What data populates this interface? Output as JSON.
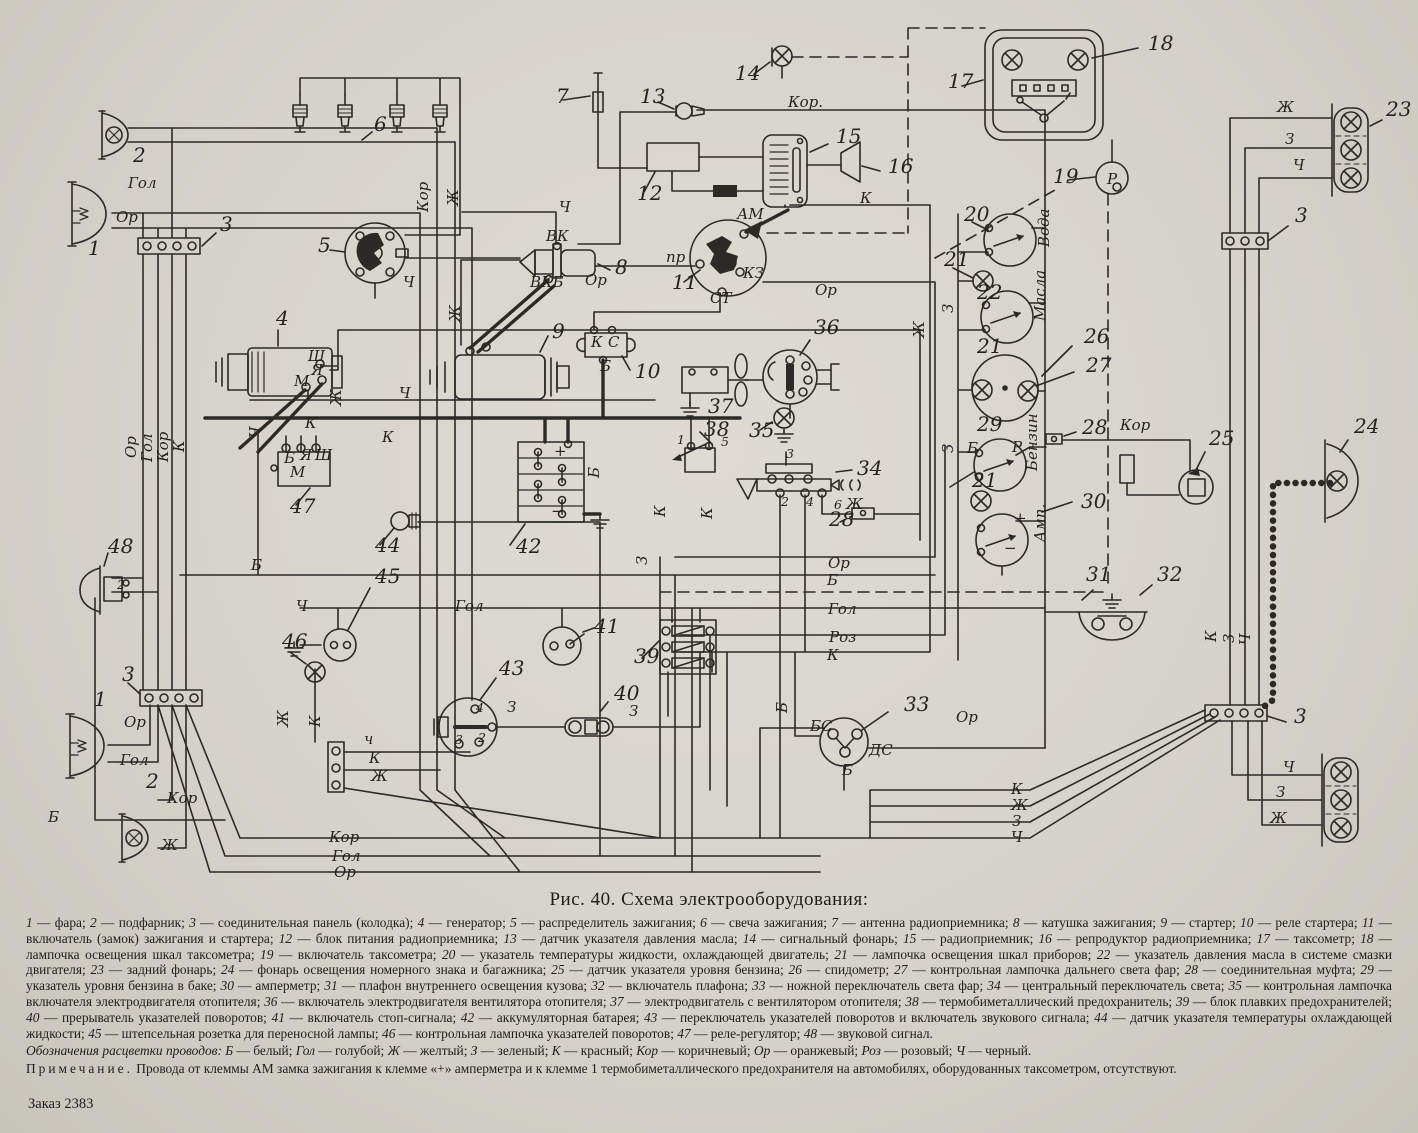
{
  "page": {
    "caption": "Рис. 40. Схема электрооборудования:",
    "order": "Заказ 2383"
  },
  "legend": {
    "items": [
      {
        "n": "1",
        "t": "фара"
      },
      {
        "n": "2",
        "t": "подфарник"
      },
      {
        "n": "3",
        "t": "соединительная панель (колодка)"
      },
      {
        "n": "4",
        "t": "генератор"
      },
      {
        "n": "5",
        "t": "распределитель зажигания"
      },
      {
        "n": "6",
        "t": "свеча зажигания"
      },
      {
        "n": "7",
        "t": "антенна радиоприемника"
      },
      {
        "n": "8",
        "t": "катушка зажигания"
      },
      {
        "n": "9",
        "t": "стартер"
      },
      {
        "n": "10",
        "t": "реле стартера"
      },
      {
        "n": "11",
        "t": "включатель (замок) зажигания и стартера"
      },
      {
        "n": "12",
        "t": "блок питания радиоприемника"
      },
      {
        "n": "13",
        "t": "датчик указателя давления масла"
      },
      {
        "n": "14",
        "t": "сигнальный фонарь"
      },
      {
        "n": "15",
        "t": "радиоприемник"
      },
      {
        "n": "16",
        "t": "репродуктор радиоприемника"
      },
      {
        "n": "17",
        "t": "таксометр"
      },
      {
        "n": "18",
        "t": "лампочка освещения шкал таксометра"
      },
      {
        "n": "19",
        "t": "включатель таксометра"
      },
      {
        "n": "20",
        "t": "указатель температуры жидкости, охлаждающей двигатель"
      },
      {
        "n": "21",
        "t": "лампочка освещения шкал приборов"
      },
      {
        "n": "22",
        "t": "указатель давления масла в системе смазки двигателя"
      },
      {
        "n": "23",
        "t": "задний фонарь"
      },
      {
        "n": "24",
        "t": "фонарь освещения номерного знака и багажника"
      },
      {
        "n": "25",
        "t": "датчик указателя уровня бензина"
      },
      {
        "n": "26",
        "t": "спидометр"
      },
      {
        "n": "27",
        "t": "контрольная лампочка дальнего света фар"
      },
      {
        "n": "28",
        "t": "соединительная муфта"
      },
      {
        "n": "29",
        "t": "указатель уровня бензина в баке"
      },
      {
        "n": "30",
        "t": "амперметр"
      },
      {
        "n": "31",
        "t": "плафон внутреннего освещения кузова"
      },
      {
        "n": "32",
        "t": "включатель плафона"
      },
      {
        "n": "33",
        "t": "ножной переключатель света фар"
      },
      {
        "n": "34",
        "t": "центральный переключатель света"
      },
      {
        "n": "35",
        "t": "контрольная лампочка включателя электродвигателя отопителя"
      },
      {
        "n": "36",
        "t": "включатель электродвигателя вентилятора отопителя"
      },
      {
        "n": "37",
        "t": "электродвигатель с вентилятором отопителя"
      },
      {
        "n": "38",
        "t": "термобиметаллический предохранитель"
      },
      {
        "n": "39",
        "t": "блок плавких предохранителей"
      },
      {
        "n": "40",
        "t": "прерыватель указателей поворотов"
      },
      {
        "n": "41",
        "t": "включатель стоп-сигнала"
      },
      {
        "n": "42",
        "t": "аккумуляторная батарея"
      },
      {
        "n": "43",
        "t": "переключатель указателей поворотов и включатель звукового сигнала"
      },
      {
        "n": "44",
        "t": "датчик указателя температуры охлаждающей жидкости"
      },
      {
        "n": "45",
        "t": "штепсельная розетка для переносной лампы"
      },
      {
        "n": "46",
        "t": "контрольная лампочка указателей поворотов"
      },
      {
        "n": "47",
        "t": "реле-регулятор"
      },
      {
        "n": "48",
        "t": "звуковой сигнал"
      }
    ]
  },
  "wire_colors": {
    "lead": "Обозначения расцветки проводов:",
    "items": [
      {
        "a": "Б",
        "t": "белый"
      },
      {
        "a": "Гол",
        "t": "голубой"
      },
      {
        "a": "Ж",
        "t": "желтый"
      },
      {
        "a": "З",
        "t": "зеленый"
      },
      {
        "a": "К",
        "t": "красный"
      },
      {
        "a": "Кор",
        "t": "коричневый"
      },
      {
        "a": "Ор",
        "t": "оранжевый"
      },
      {
        "a": "Роз",
        "t": "розовый"
      },
      {
        "a": "Ч",
        "t": "черный"
      }
    ]
  },
  "note": {
    "lead": "Примечание.",
    "text": "Провода от клеммы АМ замка зажигания к клемме «+» амперметра и к клемме 1 термобиметаллического предохранителя на автомобилях, оборудованных таксометром, отсутствуют."
  },
  "diagram": {
    "ink": "#2b2a26",
    "callouts": [
      {
        "t": "1",
        "x": 88,
        "y": 255
      },
      {
        "t": "2",
        "x": 133,
        "y": 162
      },
      {
        "t": "3",
        "x": 220,
        "y": 231
      },
      {
        "t": "4",
        "x": 276,
        "y": 325
      },
      {
        "t": "5",
        "x": 318,
        "y": 252
      },
      {
        "t": "6",
        "x": 374,
        "y": 131
      },
      {
        "t": "7",
        "x": 556,
        "y": 103
      },
      {
        "t": "8",
        "x": 615,
        "y": 274
      },
      {
        "t": "9",
        "x": 552,
        "y": 338
      },
      {
        "t": "10",
        "x": 635,
        "y": 378
      },
      {
        "t": "11",
        "x": 672,
        "y": 289
      },
      {
        "t": "12",
        "x": 637,
        "y": 200
      },
      {
        "t": "13",
        "x": 640,
        "y": 103
      },
      {
        "t": "14",
        "x": 735,
        "y": 80
      },
      {
        "t": "15",
        "x": 836,
        "y": 143
      },
      {
        "t": "16",
        "x": 888,
        "y": 173
      },
      {
        "t": "17",
        "x": 948,
        "y": 88
      },
      {
        "t": "18",
        "x": 1148,
        "y": 50
      },
      {
        "t": "19",
        "x": 1053,
        "y": 183
      },
      {
        "t": "20",
        "x": 964,
        "y": 221
      },
      {
        "t": "21",
        "x": 944,
        "y": 266
      },
      {
        "t": "22",
        "x": 977,
        "y": 299
      },
      {
        "t": "21",
        "x": 977,
        "y": 353
      },
      {
        "t": "26",
        "x": 1084,
        "y": 343
      },
      {
        "t": "27",
        "x": 1086,
        "y": 372
      },
      {
        "t": "28",
        "x": 1082,
        "y": 434
      },
      {
        "t": "29",
        "x": 977,
        "y": 431
      },
      {
        "t": "21",
        "x": 972,
        "y": 487
      },
      {
        "t": "30",
        "x": 1081,
        "y": 508
      },
      {
        "t": "25",
        "x": 1209,
        "y": 445
      },
      {
        "t": "24",
        "x": 1354,
        "y": 433
      },
      {
        "t": "31",
        "x": 1086,
        "y": 581
      },
      {
        "t": "32",
        "x": 1157,
        "y": 581
      },
      {
        "t": "33",
        "x": 904,
        "y": 711
      },
      {
        "t": "34",
        "x": 857,
        "y": 475
      },
      {
        "t": "35",
        "x": 749,
        "y": 437
      },
      {
        "t": "36",
        "x": 814,
        "y": 334
      },
      {
        "t": "37",
        "x": 708,
        "y": 413
      },
      {
        "t": "38",
        "x": 704,
        "y": 436
      },
      {
        "t": "39",
        "x": 634,
        "y": 663
      },
      {
        "t": "40",
        "x": 614,
        "y": 700
      },
      {
        "t": "41",
        "x": 594,
        "y": 633
      },
      {
        "t": "42",
        "x": 516,
        "y": 553
      },
      {
        "t": "43",
        "x": 499,
        "y": 675
      },
      {
        "t": "44",
        "x": 375,
        "y": 552
      },
      {
        "t": "45",
        "x": 375,
        "y": 583
      },
      {
        "t": "46",
        "x": 282,
        "y": 648
      },
      {
        "t": "47",
        "x": 290,
        "y": 513
      },
      {
        "t": "48",
        "x": 108,
        "y": 553
      },
      {
        "t": "23",
        "x": 1386,
        "y": 116
      },
      {
        "t": "3",
        "x": 1295,
        "y": 222
      },
      {
        "t": "3",
        "x": 1294,
        "y": 723
      },
      {
        "t": "1",
        "x": 94,
        "y": 706
      },
      {
        "t": "2",
        "x": 146,
        "y": 788
      },
      {
        "t": "3",
        "x": 122,
        "y": 681
      },
      {
        "t": "28",
        "x": 829,
        "y": 526
      }
    ],
    "labels": [
      {
        "t": "Гол",
        "x": 128,
        "y": 188
      },
      {
        "t": "Ор",
        "x": 116,
        "y": 222
      },
      {
        "t": "Кор",
        "x": 428,
        "y": 212,
        "v": 1
      },
      {
        "t": "Ж",
        "x": 458,
        "y": 206,
        "v": 1
      },
      {
        "t": "Ор",
        "x": 136,
        "y": 458,
        "v": 1
      },
      {
        "t": "Гол",
        "x": 152,
        "y": 462,
        "v": 1
      },
      {
        "t": "Кор",
        "x": 168,
        "y": 462,
        "v": 1
      },
      {
        "t": "К",
        "x": 184,
        "y": 452,
        "v": 1
      },
      {
        "t": "Ч",
        "x": 559,
        "y": 212
      },
      {
        "t": "ВК",
        "x": 546,
        "y": 241
      },
      {
        "t": "ВКБ",
        "x": 530,
        "y": 287
      },
      {
        "t": "Ор",
        "x": 585,
        "y": 285
      },
      {
        "t": "Ч",
        "x": 403,
        "y": 287
      },
      {
        "t": "Ж",
        "x": 460,
        "y": 322,
        "v": 1
      },
      {
        "t": "Кор.",
        "x": 788,
        "y": 107
      },
      {
        "t": "К",
        "x": 860,
        "y": 203
      },
      {
        "t": "АМ",
        "x": 737,
        "y": 219
      },
      {
        "t": "пр",
        "x": 666,
        "y": 262
      },
      {
        "t": "КЗ",
        "x": 743,
        "y": 278
      },
      {
        "t": "СТ",
        "x": 710,
        "y": 303
      },
      {
        "t": "Ор",
        "x": 815,
        "y": 295
      },
      {
        "t": "Ж",
        "x": 1277,
        "y": 112
      },
      {
        "t": "З",
        "x": 1285,
        "y": 144
      },
      {
        "t": "Ч",
        "x": 1293,
        "y": 170
      },
      {
        "t": "Вода",
        "x": 1049,
        "y": 247,
        "v": 1
      },
      {
        "t": "Масла",
        "x": 1045,
        "y": 321,
        "v": 1
      },
      {
        "t": "Бензин",
        "x": 1037,
        "y": 471,
        "v": 1
      },
      {
        "t": "Амп.",
        "x": 1045,
        "y": 542,
        "v": 1
      },
      {
        "t": "З",
        "x": 953,
        "y": 313,
        "v": 1
      },
      {
        "t": "З",
        "x": 953,
        "y": 453,
        "v": 1
      },
      {
        "t": "Б",
        "x": 967,
        "y": 453
      },
      {
        "t": "Р",
        "x": 1012,
        "y": 452
      },
      {
        "t": "+",
        "x": 1014,
        "y": 523
      },
      {
        "t": "−",
        "x": 1004,
        "y": 553
      },
      {
        "t": "Кор",
        "x": 1120,
        "y": 430
      },
      {
        "t": "Ш",
        "x": 308,
        "y": 361
      },
      {
        "t": "Я",
        "x": 311,
        "y": 375
      },
      {
        "t": "М",
        "x": 294,
        "y": 386
      },
      {
        "t": "Ж",
        "x": 341,
        "y": 406,
        "v": 1
      },
      {
        "t": "К",
        "x": 305,
        "y": 428
      },
      {
        "t": "Ч",
        "x": 260,
        "y": 438,
        "v": 1
      },
      {
        "t": "К",
        "x": 382,
        "y": 442
      },
      {
        "t": "Ч",
        "x": 399,
        "y": 398
      },
      {
        "t": "Б",
        "x": 284,
        "y": 463
      },
      {
        "t": "Я",
        "x": 300,
        "y": 460
      },
      {
        "t": "Ш",
        "x": 315,
        "y": 460
      },
      {
        "t": "М",
        "x": 290,
        "y": 477
      },
      {
        "t": "К",
        "x": 591,
        "y": 347
      },
      {
        "t": "С",
        "x": 608,
        "y": 347
      },
      {
        "t": "Б",
        "x": 600,
        "y": 371
      },
      {
        "t": "+",
        "x": 554,
        "y": 456
      },
      {
        "t": "−",
        "x": 551,
        "y": 516
      },
      {
        "t": "Б",
        "x": 599,
        "y": 478,
        "v": 1
      },
      {
        "t": "Б",
        "x": 251,
        "y": 570
      },
      {
        "t": "Б",
        "x": 48,
        "y": 822
      },
      {
        "t": "К",
        "x": 665,
        "y": 517,
        "v": 1
      },
      {
        "t": "К",
        "x": 712,
        "y": 519,
        "v": 1
      },
      {
        "t": "З",
        "x": 647,
        "y": 565,
        "v": 1
      },
      {
        "t": "1",
        "x": 677,
        "y": 444
      },
      {
        "t": "5",
        "x": 721,
        "y": 446
      },
      {
        "t": "3",
        "x": 786,
        "y": 458
      },
      {
        "t": "2",
        "x": 781,
        "y": 506
      },
      {
        "t": "4",
        "x": 806,
        "y": 506
      },
      {
        "t": "6",
        "x": 834,
        "y": 509
      },
      {
        "t": "Ж",
        "x": 846,
        "y": 509
      },
      {
        "t": "Ор",
        "x": 828,
        "y": 568
      },
      {
        "t": "Б",
        "x": 827,
        "y": 585
      },
      {
        "t": "Гол",
        "x": 828,
        "y": 614
      },
      {
        "t": "Роз",
        "x": 829,
        "y": 642
      },
      {
        "t": "К",
        "x": 827,
        "y": 660
      },
      {
        "t": "Гол",
        "x": 455,
        "y": 611
      },
      {
        "t": "З",
        "x": 507,
        "y": 712
      },
      {
        "t": "З",
        "x": 629,
        "y": 716
      },
      {
        "t": "4",
        "x": 476,
        "y": 712
      },
      {
        "t": "2",
        "x": 478,
        "y": 742
      },
      {
        "t": "3",
        "x": 455,
        "y": 744
      },
      {
        "t": "БС",
        "x": 810,
        "y": 731
      },
      {
        "t": "ДС",
        "x": 869,
        "y": 755
      },
      {
        "t": "Б",
        "x": 842,
        "y": 775
      },
      {
        "t": "Б",
        "x": 787,
        "y": 713,
        "v": 1
      },
      {
        "t": "Ор",
        "x": 956,
        "y": 722
      },
      {
        "t": "Ор",
        "x": 124,
        "y": 727
      },
      {
        "t": "Гол",
        "x": 120,
        "y": 765
      },
      {
        "t": "Кор",
        "x": 167,
        "y": 803
      },
      {
        "t": "Ж",
        "x": 161,
        "y": 850
      },
      {
        "t": "Ч",
        "x": 296,
        "y": 611
      },
      {
        "t": "Ж",
        "x": 288,
        "y": 727,
        "v": 1
      },
      {
        "t": "К",
        "x": 320,
        "y": 727,
        "v": 1
      },
      {
        "t": "ч",
        "x": 364,
        "y": 744
      },
      {
        "t": "К",
        "x": 369,
        "y": 763
      },
      {
        "t": "Ж",
        "x": 371,
        "y": 781
      },
      {
        "t": "Кор",
        "x": 329,
        "y": 842
      },
      {
        "t": "Гол",
        "x": 332,
        "y": 861
      },
      {
        "t": "Ор",
        "x": 334,
        "y": 877
      },
      {
        "t": "К",
        "x": 1011,
        "y": 794
      },
      {
        "t": "Ж",
        "x": 1011,
        "y": 810
      },
      {
        "t": "З",
        "x": 1012,
        "y": 826
      },
      {
        "t": "Ч",
        "x": 1011,
        "y": 842
      },
      {
        "t": "К",
        "x": 1216,
        "y": 642,
        "v": 1
      },
      {
        "t": "З",
        "x": 1234,
        "y": 643,
        "v": 1
      },
      {
        "t": "Ч",
        "x": 1250,
        "y": 645,
        "v": 1
      },
      {
        "t": "Ч",
        "x": 1283,
        "y": 772
      },
      {
        "t": "З",
        "x": 1276,
        "y": 797
      },
      {
        "t": "Ж",
        "x": 1270,
        "y": 823
      },
      {
        "t": "Ж",
        "x": 924,
        "y": 338,
        "v": 1
      },
      {
        "t": "2",
        "x": 117,
        "y": 589
      },
      {
        "t": "Р",
        "x": 1107,
        "y": 184
      }
    ]
  }
}
